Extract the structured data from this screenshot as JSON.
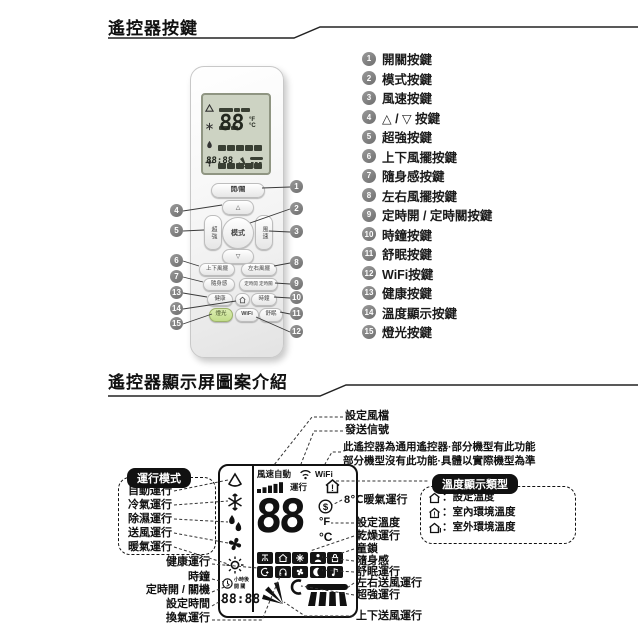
{
  "section1": {
    "title": "遙控器按鍵",
    "remote": {
      "power": "開/關",
      "up": "△",
      "down": "▽",
      "mode": "模式",
      "turbo": "超強",
      "fan": "風速",
      "swing_ud": "上下風擺",
      "swing_lr": "左右風擺",
      "ifeel": "隨身感",
      "timer": "定時開 定時關",
      "health": "健康",
      "clock": "時鐘",
      "light": "燈光",
      "wifi": "WiFi",
      "sleep": "舒眠",
      "screen_temp": "88",
      "screen_time": "88:88"
    },
    "legend": [
      {
        "num": "1",
        "label": "開關按鍵"
      },
      {
        "num": "2",
        "label": "模式按鍵"
      },
      {
        "num": "3",
        "label": "風速按鍵"
      },
      {
        "num": "4",
        "label": "△ / ▽ 按鍵"
      },
      {
        "num": "5",
        "label": "超強按鍵"
      },
      {
        "num": "6",
        "label": "上下風擺按鍵"
      },
      {
        "num": "7",
        "label": "隨身感按鍵"
      },
      {
        "num": "8",
        "label": "左右風擺按鍵"
      },
      {
        "num": "9",
        "label": "定時開 / 定時關按鍵"
      },
      {
        "num": "10",
        "label": "時鐘按鍵"
      },
      {
        "num": "11",
        "label": "舒眠按鍵"
      },
      {
        "num": "12",
        "label": "WiFi按鍵"
      },
      {
        "num": "13",
        "label": "健康按鍵"
      },
      {
        "num": "14",
        "label": "溫度顯示按鍵"
      },
      {
        "num": "15",
        "label": "燈光按鍵"
      }
    ]
  },
  "section2": {
    "title": "遙控器顯示屏圖案介紹",
    "labels": {
      "fan_gear": "設定風檔",
      "signal": "發送信號",
      "note1": "此遙控器為通用遙控器·部分機型有此功能",
      "note2": "部分機型沒有此功能·具體以實際機型為準",
      "heat8": "8℃暖氣運行",
      "set_temp": "設定溫度",
      "dry": "乾燥運行",
      "child_lock": "童鎖",
      "ifeel": "隨身感",
      "sleep": "舒眠運行",
      "lr_air": "左右送風運行",
      "turbo": "超強運行",
      "ud_air": "上下送風運行",
      "health": "健康運行",
      "clock": "時鐘",
      "timer_onoff": "定時開 / 關機",
      "set_time": "設定時間",
      "vent": "換氣運行"
    },
    "mode_box": {
      "title": "運行模式",
      "items": [
        "自動運行",
        "冷氣運行",
        "除濕運行",
        "送風運行",
        "暖氣運行"
      ]
    },
    "temp_box": {
      "title": "溫度顯示類型",
      "items": [
        {
          "label": "：設定溫度"
        },
        {
          "label": "：室內環境溫度"
        },
        {
          "label": "：室外環境溫度"
        }
      ]
    },
    "lcd": {
      "fan_speed": "風速自動",
      "run": "運行",
      "wifi": "WiFi",
      "temp": "88",
      "fahrenheit": "°F",
      "celsius": "°C",
      "dollar": "$",
      "house_mark": "!",
      "hours_after": "小時後",
      "on_off": "開 關",
      "time": "88:88"
    }
  }
}
